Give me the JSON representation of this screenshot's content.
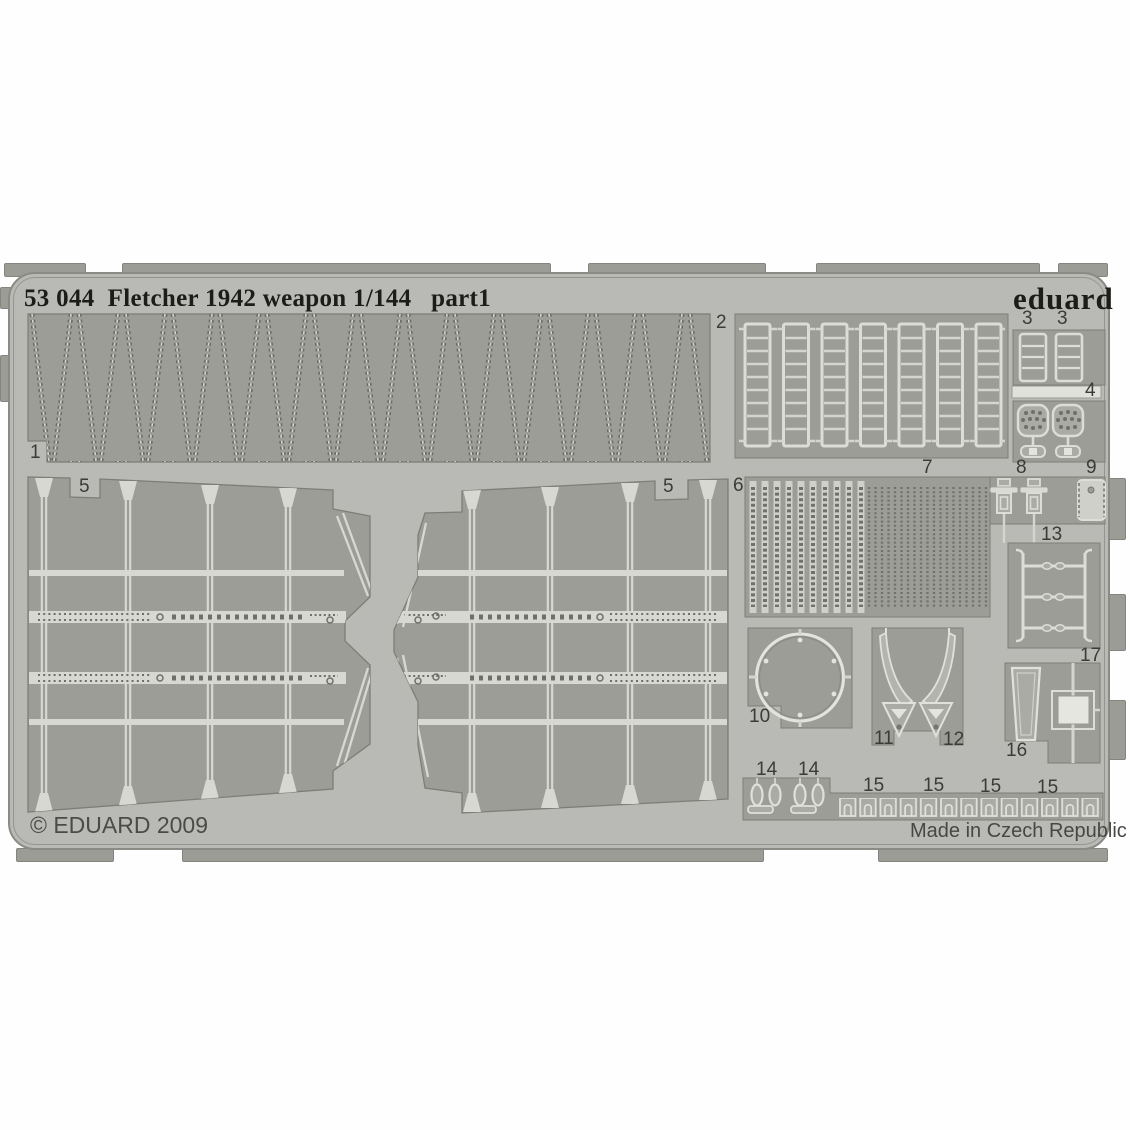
{
  "photo": {
    "plate_title": "53 044  Fletcher 1942 weapon 1/144   part1",
    "brand_logo": "eduard",
    "copyright": "© EDUARD 2009",
    "made_in": "Made in Czech Republic"
  },
  "part_labels": [
    {
      "n": "1",
      "x": 30,
      "y": 443
    },
    {
      "n": "2",
      "x": 716,
      "y": 313
    },
    {
      "n": "3",
      "x": 1022,
      "y": 309
    },
    {
      "n": "3",
      "x": 1057,
      "y": 309
    },
    {
      "n": "4",
      "x": 1085,
      "y": 381
    },
    {
      "n": "5",
      "x": 79,
      "y": 477
    },
    {
      "n": "5",
      "x": 663,
      "y": 477
    },
    {
      "n": "6",
      "x": 733,
      "y": 476
    },
    {
      "n": "7",
      "x": 922,
      "y": 458
    },
    {
      "n": "8",
      "x": 1016,
      "y": 458
    },
    {
      "n": "9",
      "x": 1086,
      "y": 458
    },
    {
      "n": "10",
      "x": 749,
      "y": 707
    },
    {
      "n": "11",
      "x": 874,
      "y": 729
    },
    {
      "n": "12",
      "x": 943,
      "y": 730
    },
    {
      "n": "13",
      "x": 1041,
      "y": 525
    },
    {
      "n": "14",
      "x": 756,
      "y": 760
    },
    {
      "n": "14",
      "x": 798,
      "y": 760
    },
    {
      "n": "15",
      "x": 863,
      "y": 776
    },
    {
      "n": "15",
      "x": 923,
      "y": 776
    },
    {
      "n": "15",
      "x": 980,
      "y": 777
    },
    {
      "n": "15",
      "x": 1037,
      "y": 778
    },
    {
      "n": "16",
      "x": 1006,
      "y": 741
    },
    {
      "n": "17",
      "x": 1080,
      "y": 646
    }
  ],
  "colors": {
    "background": "#fefefe",
    "fret_gray": "#b9bab5",
    "pad_gray": "#9c9d97",
    "etch_light": "#dcddd7",
    "title_text": "#1c1c1a",
    "label_text": "#3b3b37"
  }
}
